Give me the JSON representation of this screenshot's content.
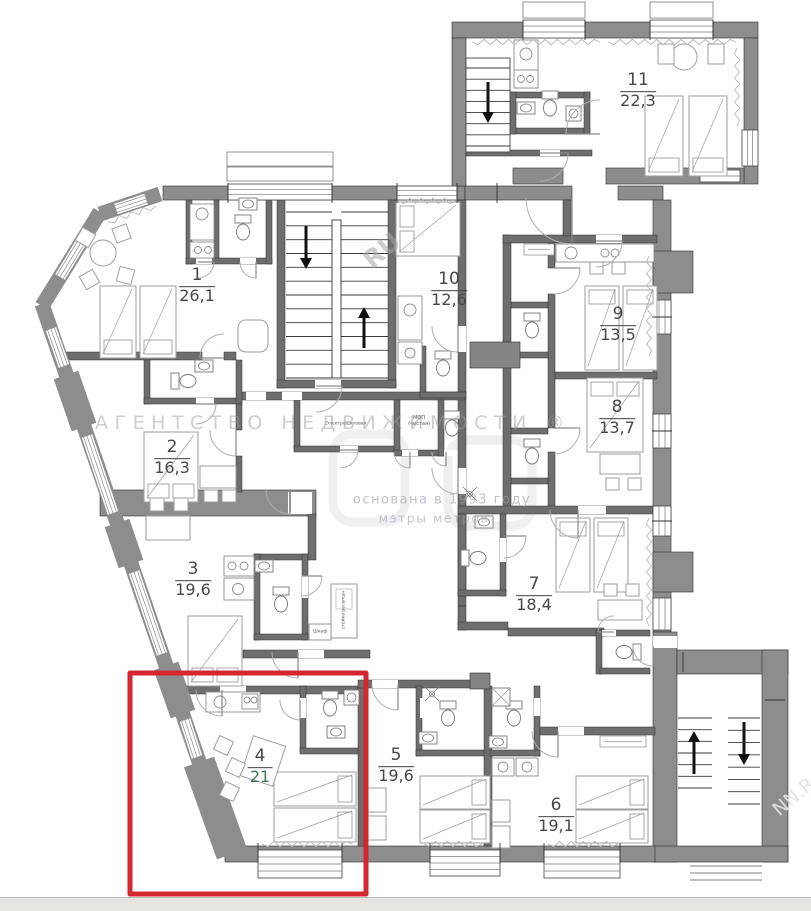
{
  "plan": {
    "type": "floor-plan",
    "highlight_color": "#d4262e",
    "wall_color": "#8d8d8d"
  },
  "rooms": [
    {
      "number": "1",
      "area": "26,1"
    },
    {
      "number": "2",
      "area": "16,3"
    },
    {
      "number": "3",
      "area": "19,6"
    },
    {
      "number": "4",
      "area": "21",
      "highlighted": true
    },
    {
      "number": "5",
      "area": "19,6"
    },
    {
      "number": "6",
      "area": "19,1"
    },
    {
      "number": "7",
      "area": "18,4"
    },
    {
      "number": "8",
      "area": "13,7"
    },
    {
      "number": "9",
      "area": "13,5"
    },
    {
      "number": "10",
      "area": "12,6"
    },
    {
      "number": "11",
      "area": "22,3"
    }
  ],
  "service_labels": {
    "mop_line1": "МОП",
    "mop_line2": "(чистая)",
    "electrical": "Электрощитовая",
    "wardrobe": "Шкаф",
    "reception": "стойка ресепшн"
  },
  "watermark": {
    "agency": "АГЕНТСТВО НЕДВИЖИМОСТИ ®",
    "founded": "основана в 1993 году",
    "slogan": "мэтры метров",
    "fragment_top": "RU",
    "fragment_bottom": "NN.R"
  }
}
